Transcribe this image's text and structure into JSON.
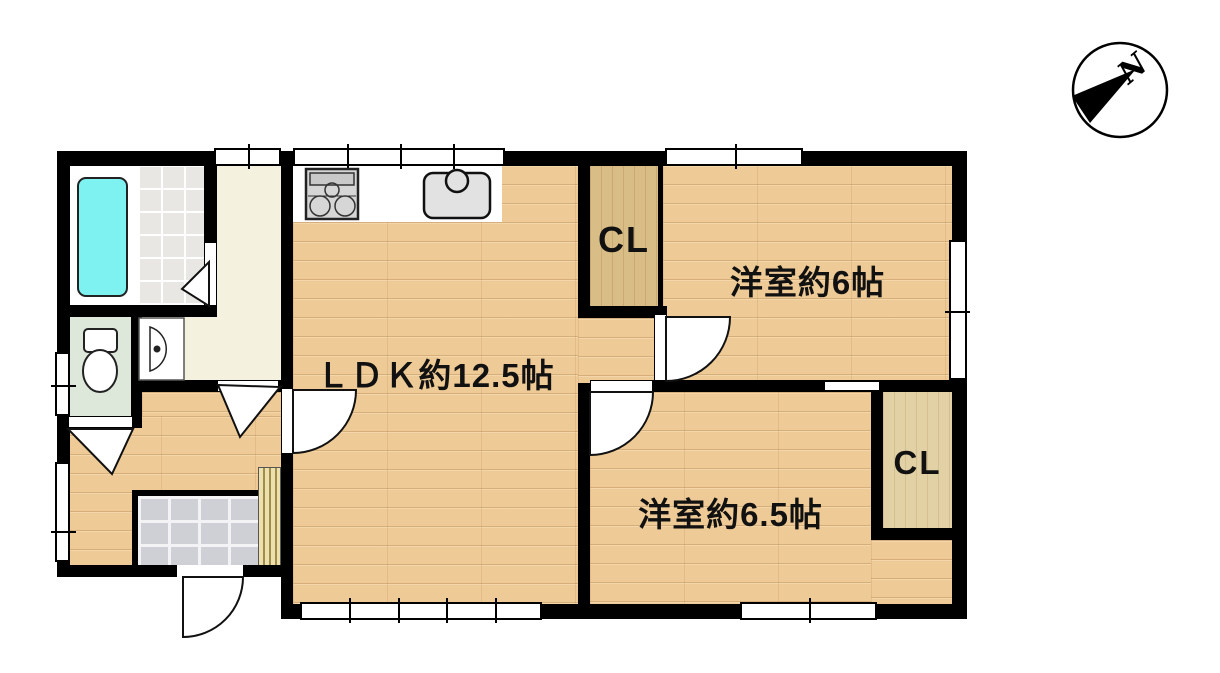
{
  "plan": {
    "title": "間取り図",
    "compass": {
      "label": "N"
    },
    "rooms": [
      {
        "name": "ldk",
        "label": "ＬＤＫ約12.5帖"
      },
      {
        "name": "western-room-6",
        "label": "洋室約6帖"
      },
      {
        "name": "western-room-6-5",
        "label": "洋室約6.5帖"
      }
    ],
    "closets": [
      {
        "name": "closet-north",
        "label": "CL"
      },
      {
        "name": "closet-south",
        "label": "CL"
      }
    ],
    "fixtures": [
      "bathtub-icon",
      "toilet-icon",
      "washbasin-icon",
      "stove-icon",
      "kitchen-sink-icon",
      "compass-needle-icon"
    ],
    "colors": {
      "wall": "#000000",
      "wood_floor": "#eeca97",
      "closet_wood": "#d9bd87",
      "closet_wood_light": "#e2d1a5",
      "bathtub": "#7ef2f0",
      "bath_tile": "#e9e7e3",
      "toilet_floor": "#dee8da",
      "washroom_floor": "#f4f2de",
      "entrance_tile": "#cfd0d6",
      "step": "#eee0ad"
    }
  }
}
